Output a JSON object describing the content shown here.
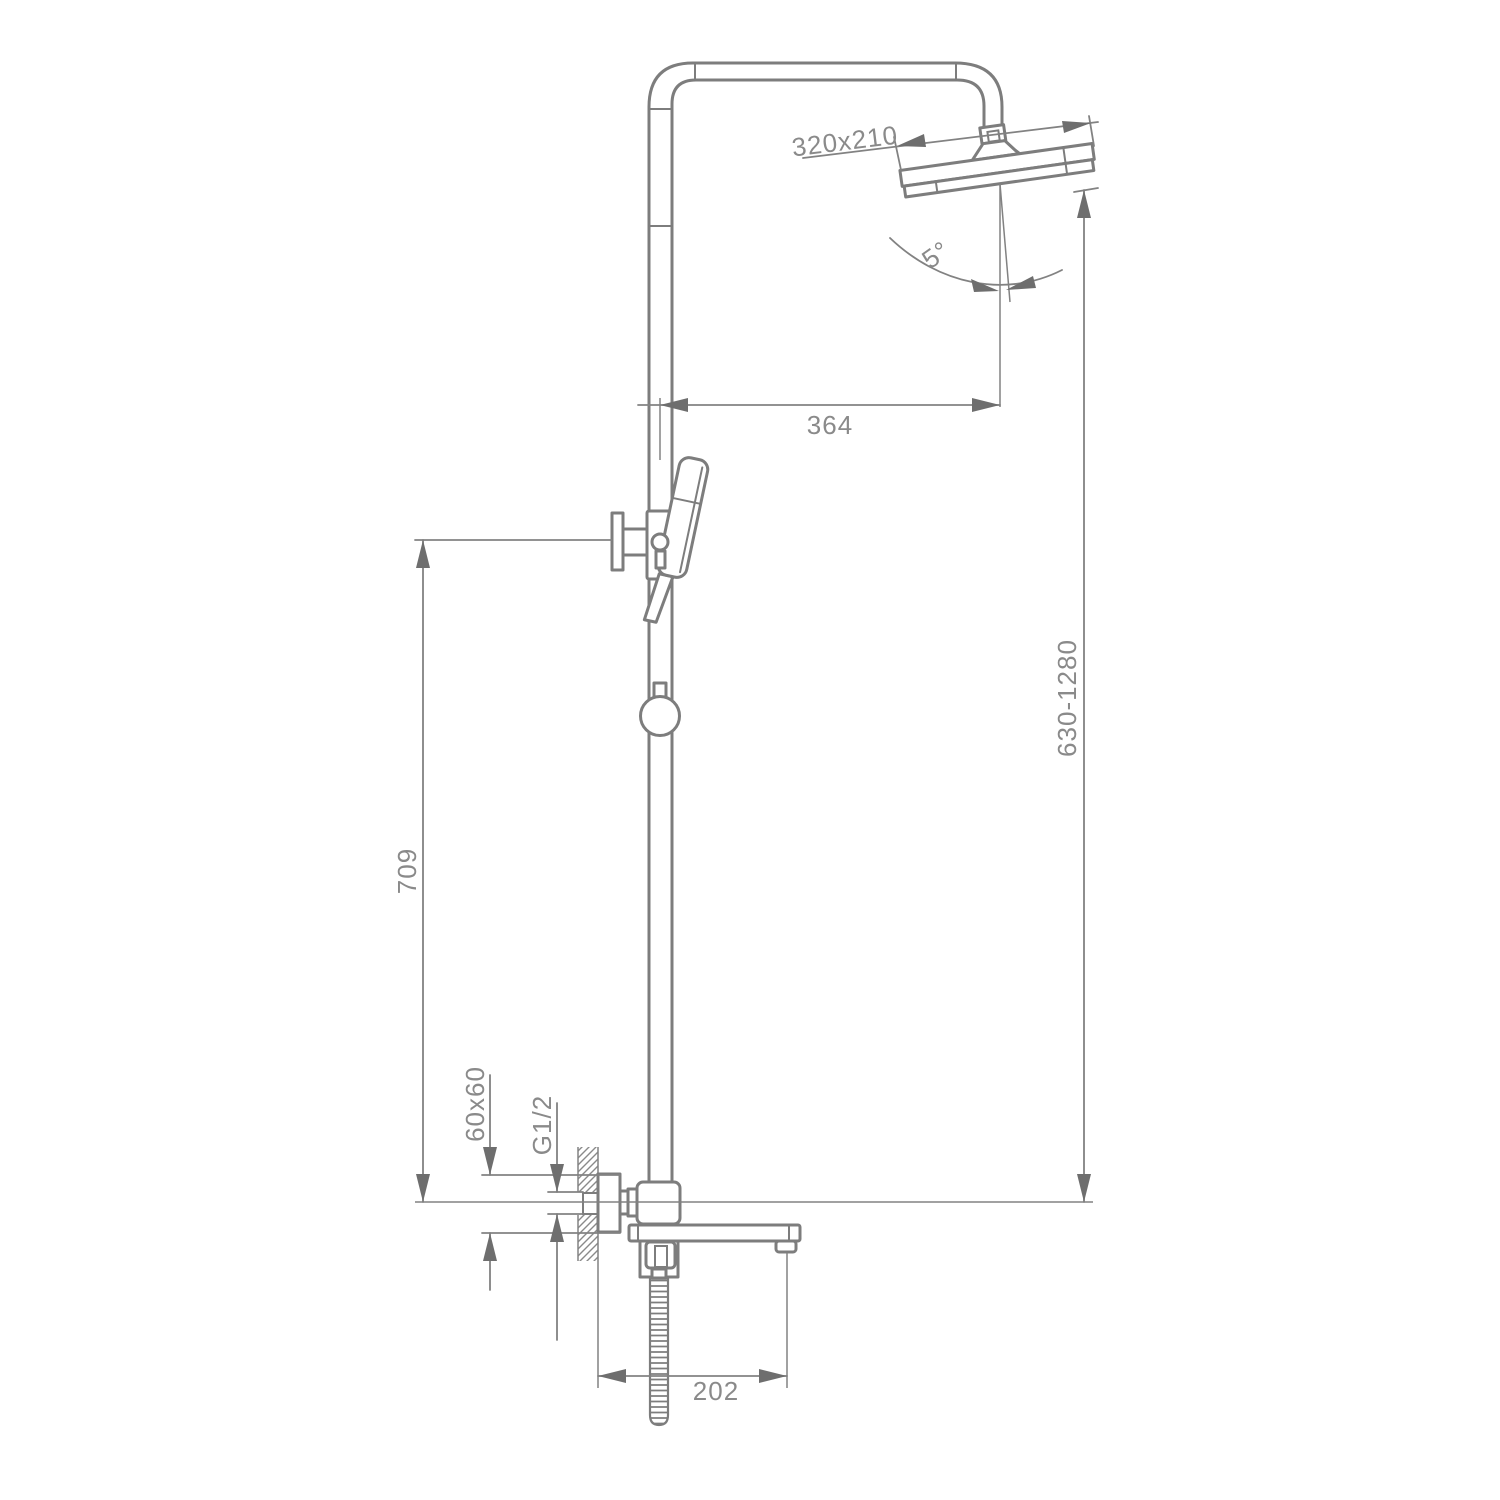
{
  "drawing": {
    "type": "technical dimension drawing",
    "subject": "wall-mounted shower column with rain head, hand shower and tub spout",
    "background": "#ffffff",
    "line_color": "#7d7d7d",
    "text_color": "#8a8a8a",
    "labels": {
      "head_size": "320x210",
      "head_angle": "5°",
      "arm_offset": "364",
      "bracket_height": "709",
      "riser_height": "630-1280",
      "escutcheon_size": "60x60",
      "thread": "G1/2",
      "spout_reach": "202"
    }
  }
}
